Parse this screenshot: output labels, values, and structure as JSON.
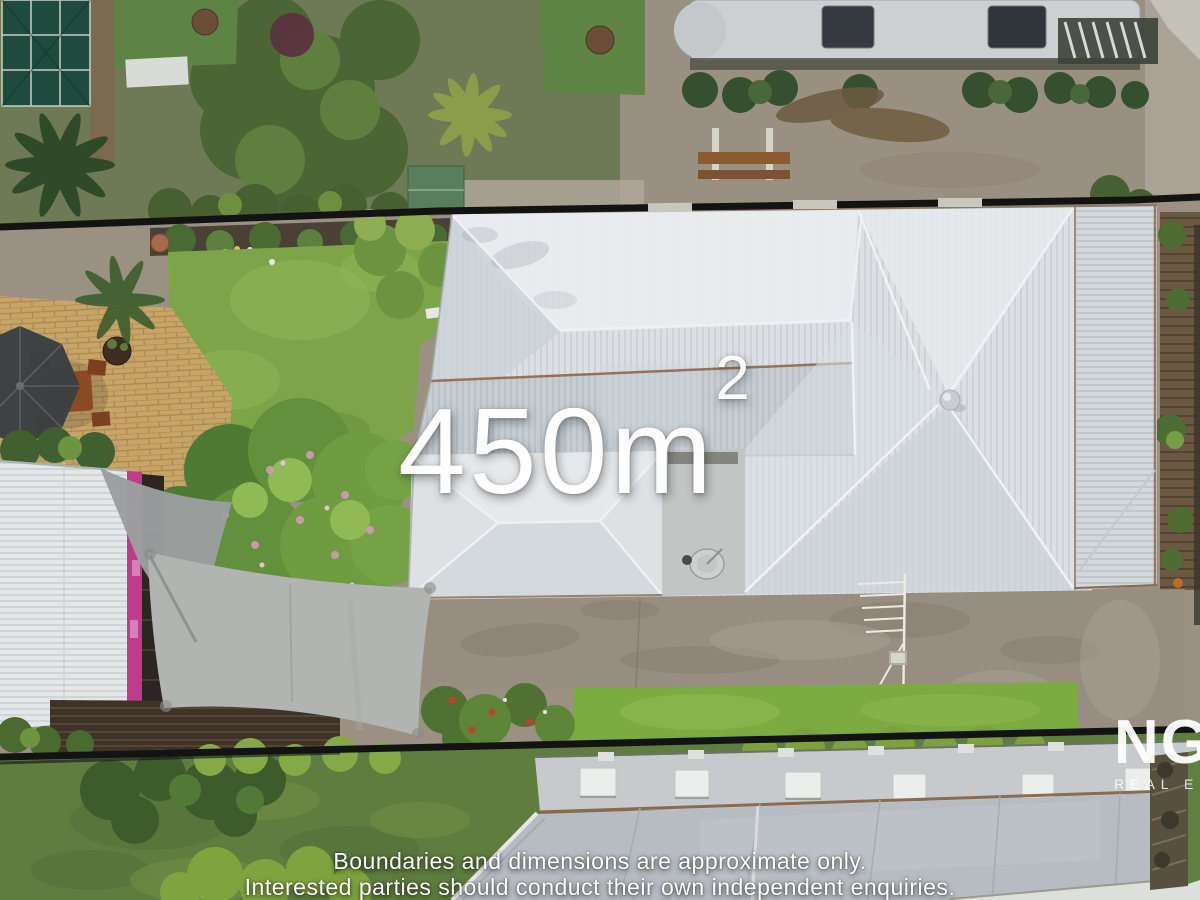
{
  "overlay": {
    "area_value": "450m",
    "area_superscript": "2"
  },
  "disclaimer": {
    "line1": "Boundaries and dimensions are approximate only.",
    "line2": "Interested parties should conduct their own independent enquiries."
  },
  "watermark": {
    "line1": "NG",
    "line2": "REAL ES"
  },
  "colors": {
    "overlay_text": "#ffffff",
    "boundary_line": "#131313",
    "roof_main": "#dce0e3",
    "roof_shade": "#c5cdd3",
    "lawn": "#7da449",
    "lawn_strip": "#7cab42",
    "concrete_driveway": "#978e81",
    "patio_pavers": "#c7a468",
    "shade_sail": "#b2b4b2",
    "pink_trim": "#c03b8c",
    "greenhouse": "#1f4a3e",
    "bottom_roof": "#b6bcc1"
  }
}
